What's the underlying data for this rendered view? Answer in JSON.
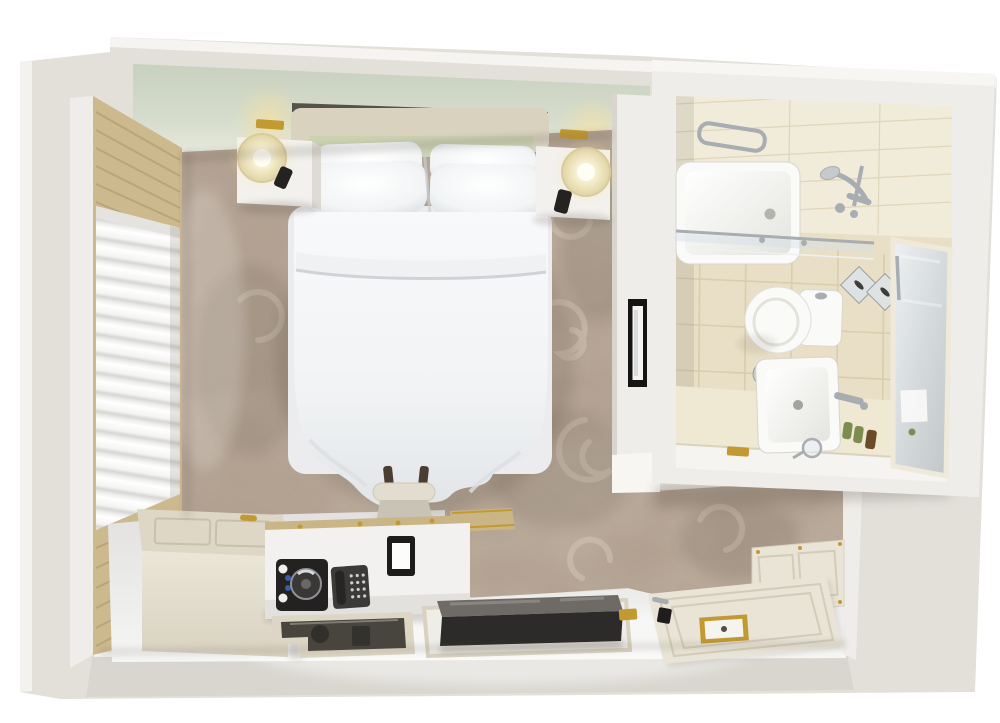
{
  "scene": {
    "description": "3D top-down floor plan render of a hotel guest room: bedroom with double bed, window with roman shade, nightstands and lamps, desk with kettle tray and telephone, TV, luggage bench, entry door laid open, and an en-suite bathroom with bathtub, shower, toilet, vanity sink and mirror.",
    "rooms": [
      {
        "id": "bedroom"
      },
      {
        "id": "bathroom"
      },
      {
        "id": "entry"
      }
    ],
    "objects": [
      {
        "id": "double-bed"
      },
      {
        "id": "headboard"
      },
      {
        "id": "pillows"
      },
      {
        "id": "duvet"
      },
      {
        "id": "nightstand-left"
      },
      {
        "id": "nightstand-right"
      },
      {
        "id": "table-lamp-left"
      },
      {
        "id": "table-lamp-right"
      },
      {
        "id": "remote-control-left"
      },
      {
        "id": "remote-control-right"
      },
      {
        "id": "wall-sconce-left"
      },
      {
        "id": "wall-sconce-right"
      },
      {
        "id": "window-roman-shade"
      },
      {
        "id": "window-wood-panel"
      },
      {
        "id": "patterned-carpet"
      },
      {
        "id": "luggage-rack"
      },
      {
        "id": "storage-bench"
      },
      {
        "id": "desk-credenza"
      },
      {
        "id": "kettle-tray"
      },
      {
        "id": "telephone"
      },
      {
        "id": "info-tablet"
      },
      {
        "id": "glass-coffee-table"
      },
      {
        "id": "television"
      },
      {
        "id": "tv-console"
      },
      {
        "id": "gold-remote"
      },
      {
        "id": "wall-art-mirror"
      },
      {
        "id": "entry-door"
      },
      {
        "id": "door-plate"
      },
      {
        "id": "door-handle"
      },
      {
        "id": "keycard-lock"
      },
      {
        "id": "wainscot-panel"
      },
      {
        "id": "card-switch"
      },
      {
        "id": "bathtub"
      },
      {
        "id": "towel-rail"
      },
      {
        "id": "shower-mixer"
      },
      {
        "id": "shower-glass-screen"
      },
      {
        "id": "toilet"
      },
      {
        "id": "waste-bin"
      },
      {
        "id": "vanity-counter"
      },
      {
        "id": "vessel-sink"
      },
      {
        "id": "faucet"
      },
      {
        "id": "toiletry-bottles"
      },
      {
        "id": "cosmetic-mirror"
      },
      {
        "id": "gold-soap-dish"
      },
      {
        "id": "tissue-boxes"
      },
      {
        "id": "bathroom-mirror"
      },
      {
        "id": "towel-ring"
      }
    ]
  },
  "colors": {
    "wall_outer": "#e3e0da",
    "wall_face": "#efede9",
    "wall_top": "#f7f6f3",
    "wall_shade": "#d9d6cf",
    "soffit": "#d3dac9",
    "soffit_light": "#e9ece0",
    "carpet_base": "#b4a494",
    "carpet_dark": "#83705f",
    "carpet_light": "#d8ccbd",
    "vinyl": "#e9e9e8",
    "vinyl_light": "#f6f6f5",
    "wood": "#ccb98e",
    "wood_dark": "#a9956a",
    "curtain": "#f8f8f7",
    "curtain_shadow": "#d8d7d4",
    "bed_white": "#f5f6f7",
    "bed_shadow": "#d8dade",
    "headboard": "#d9d2bf",
    "headboard_band": "#cbd2b2",
    "headboard_gap": "#3e3a33",
    "furn_cream_top": "#ded7c6",
    "furn_cream_front": "#e8e2d4",
    "furn_white": "#f2f1ee",
    "furn_white_side": "#dedbd4",
    "lamp_shade": "#eadfb4",
    "lamp_center": "#fffef4",
    "desk_wood": "#c9b586",
    "tv_front": "#2d2b29",
    "tv_top": "#6e6a66",
    "glass_dark": "#48443e",
    "tile_floor": "#e9dfc6",
    "tile_wall": "#f1ebd9",
    "grout": "#d6caa9",
    "porcelain": "#fafaf8",
    "porcelain_shade": "#d8d8d2",
    "chrome": "#a8adb2",
    "chrome_dark": "#7d8287",
    "gold": "#c39a31",
    "gold_light": "#e6c266",
    "door_cream": "#e9e4d6",
    "door_line": "#d3ccba",
    "dark_device": "#242322",
    "mirror_light": "#e9edee",
    "mirror_dark": "#c4cacc",
    "artwork_frame": "#161513",
    "shadow": "#5a4f44"
  }
}
